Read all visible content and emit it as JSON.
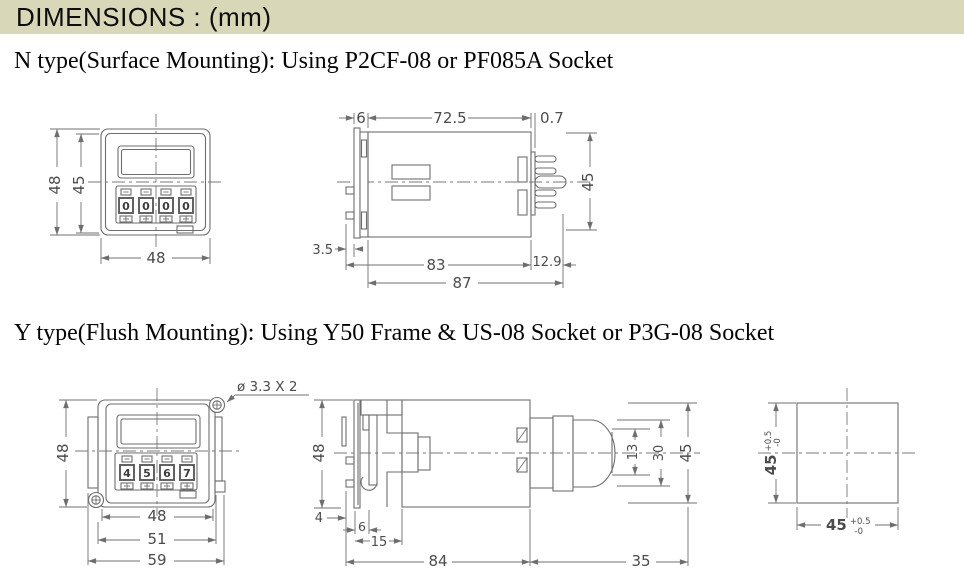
{
  "header": {
    "title": "DIMENSIONS : (mm)",
    "bar_color": "#d8d8b8"
  },
  "sections": {
    "n": {
      "heading": "N type(Surface Mounting): Using P2CF-08 or PF085A Socket"
    },
    "y": {
      "heading": "Y type(Flush Mounting): Using Y50 Frame & US-08 Socket or P3G-08 Socket"
    }
  },
  "n_front": {
    "height": "48",
    "inner_height": "45",
    "width": "48",
    "digits": [
      "0",
      "0",
      "0",
      "0"
    ]
  },
  "n_side": {
    "bezel_depth": "6",
    "body_length": "72.5",
    "plate_gap": "0.7",
    "height": "45",
    "peg_depth": "3.5",
    "mount_length": "83",
    "pin_length": "12.9",
    "total_length": "87"
  },
  "y_front": {
    "screw_callout": "ø 3.3 X 2",
    "height": "48",
    "width": "48",
    "frame_width": "51",
    "flange_width": "59",
    "digits": [
      "4",
      "5",
      "6",
      "7"
    ]
  },
  "y_side": {
    "height": "48",
    "panel_offset": "4",
    "bezel_depth": "6",
    "frame_depth": "15",
    "body_length": "84",
    "socket_length": "35",
    "tip_height": "13",
    "socket_height": "30",
    "socket_flange_height": "45"
  },
  "cutout": {
    "width": "45",
    "height": "45",
    "tol_plus": "+0.5",
    "tol_minus": "-0"
  }
}
